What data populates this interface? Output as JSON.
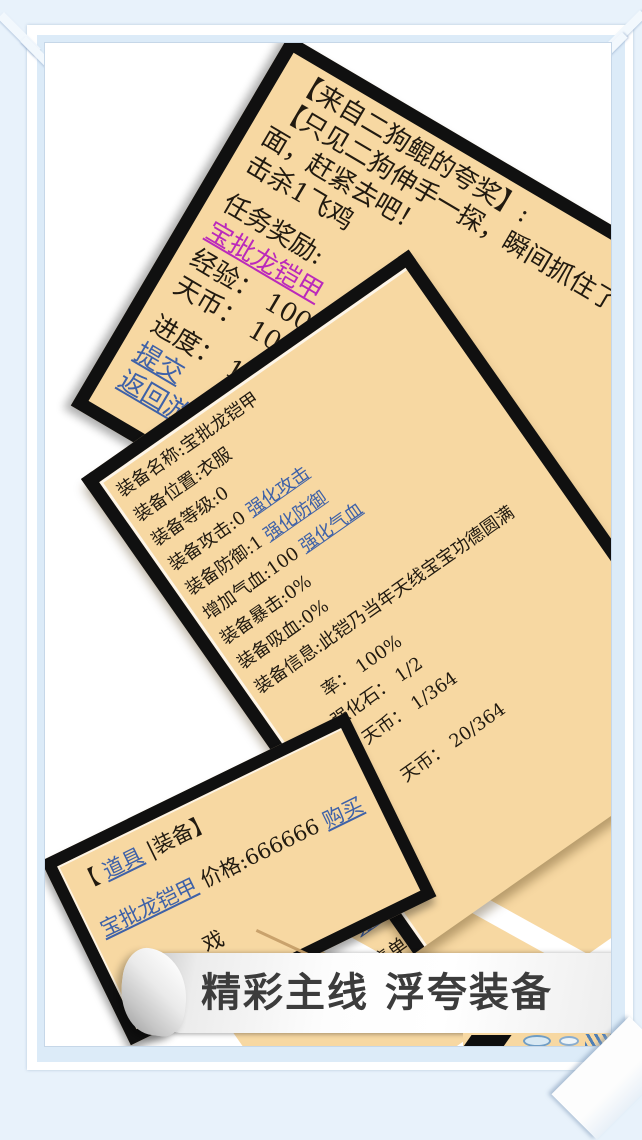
{
  "caption": {
    "text": "精彩主线 浮夸装备"
  },
  "quest": {
    "l1": "【来自二狗鲲的夸奖】:",
    "l2": "【只见二狗伸手一探，瞬间抓住了",
    "l3": "面，赶紧去吧！",
    "l4": "击杀1飞鸡",
    "l5": "任务奖励:",
    "l6": "宝批龙铠甲",
    "l7": "经验： 100",
    "l8": "天币： 100",
    "l9": "进度： 1/1",
    "l10": "提交",
    "l11": "返回游戏"
  },
  "equipment": {
    "l1": "装备名称:宝批龙铠甲",
    "l2": "装备位置:衣服",
    "l3": "装备等级:0",
    "l4a": "装备攻击:0 ",
    "l4b": "强化攻击",
    "l5a": "装备防御:1 ",
    "l5b": "强化防御",
    "l6a": "增加气血:100 ",
    "l6b": "强化气血",
    "l7": "装备暴击:0%",
    "l8": "装备吸血:0%",
    "l9": "装备信息:此铠乃当年天线宝宝功德圆满",
    "frag_rate": "率： 100%",
    "frag_stone": "强化石： 1/2",
    "frag_coin1": "天币： 1/364",
    "frag_coin2": "天币： 20/364",
    "frag_equip_link_end": "备"
  },
  "actions": {
    "disassemble": "分解该装备",
    "sell_price": "出售单价："
  },
  "shop": {
    "bracket_open": "【 ",
    "tab_items": "道具",
    "tab_rest": " |装备】",
    "item_name": "宝批龙铠甲",
    "price_text": " 价格:666666 ",
    "buy": "购买",
    "partial_char": "戏"
  },
  "colors": {
    "panel_bg": "#f7d8a2",
    "panel_border": "#101010",
    "link_blue": "#3e61a8",
    "link_magenta": "#bb29bb",
    "body_text": "#211a10",
    "caption_text": "#3c3c3c",
    "frame_blue_band": "#dcebf8",
    "frame_outer": "#e8f2fb"
  }
}
